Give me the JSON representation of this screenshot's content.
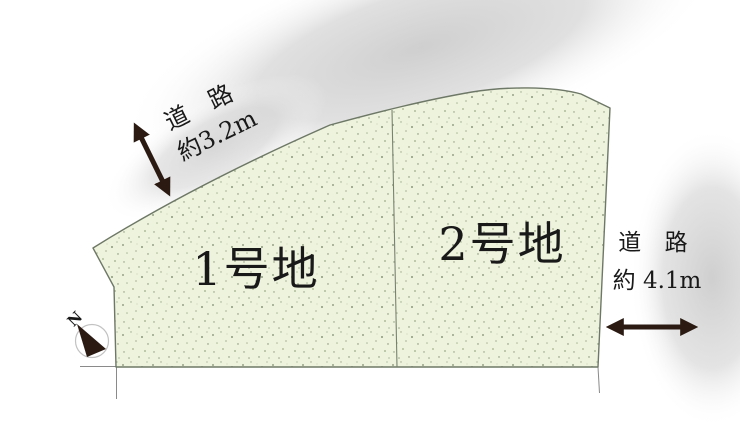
{
  "plots": [
    {
      "label": "1号地"
    },
    {
      "label": "2号地"
    }
  ],
  "roads": {
    "top_left": {
      "name": "道 路",
      "width": "約3.2m"
    },
    "right": {
      "name": "道 路",
      "width": "約 4.1m"
    }
  },
  "compass": {
    "north_label": "N"
  },
  "colors": {
    "plot_fill": "#eef3de",
    "plot_stroke": "#6e7866",
    "road_gray": "#d2d2d2",
    "arrow": "#2a1a12",
    "text": "#191919",
    "guide_line": "#8a8a8a"
  }
}
